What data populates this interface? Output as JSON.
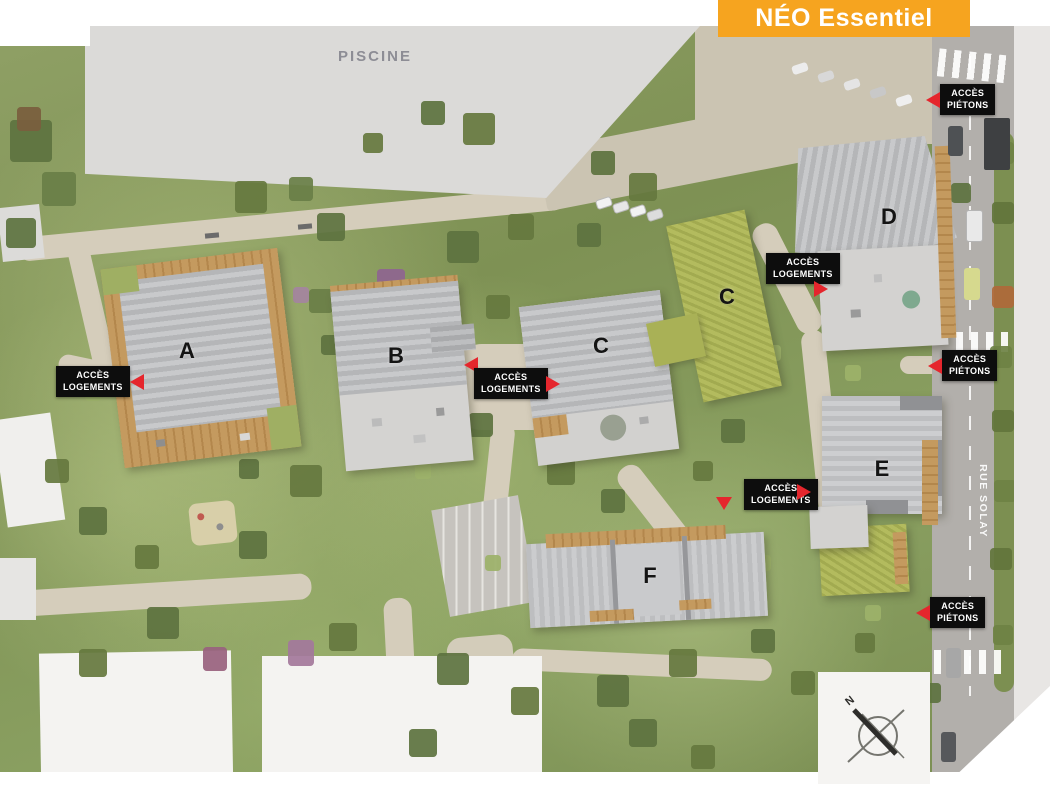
{
  "banner": {
    "title": "NÉO Essentiel"
  },
  "map": {
    "pool_label": "PISCINE",
    "street_label": "RUE SOLAY",
    "compass_label": "N",
    "buildings": [
      {
        "label": "A"
      },
      {
        "label": "B"
      },
      {
        "label": "C"
      },
      {
        "label": "C"
      },
      {
        "label": "D"
      },
      {
        "label": "E"
      },
      {
        "label": "F"
      }
    ],
    "access_points": [
      {
        "id": "logements-west",
        "line1": "ACCÈS",
        "line2": "LOGEMENTS"
      },
      {
        "id": "logements-central",
        "line1": "ACCÈS",
        "line2": "LOGEMENTS"
      },
      {
        "id": "logements-d",
        "line1": "ACCÈS",
        "line2": "LOGEMENTS"
      },
      {
        "id": "logements-e",
        "line1": "ACCÈS",
        "line2": "LOGEMENTS"
      },
      {
        "id": "pietons-north",
        "line1": "ACCÈS",
        "line2": "PIÉTONS"
      },
      {
        "id": "pietons-mid",
        "line1": "ACCÈS",
        "line2": "PIÉTONS"
      },
      {
        "id": "pietons-south",
        "line1": "ACCÈS",
        "line2": "PIÉTONS"
      }
    ]
  },
  "colors": {
    "banner_bg": "#F6A41F",
    "banner_fg": "#FFFFFF",
    "access_bg": "#0D0D0D",
    "access_fg": "#FFFFFF",
    "arrow_red": "#E5262D",
    "pool_gray": "#DBDAD8"
  }
}
